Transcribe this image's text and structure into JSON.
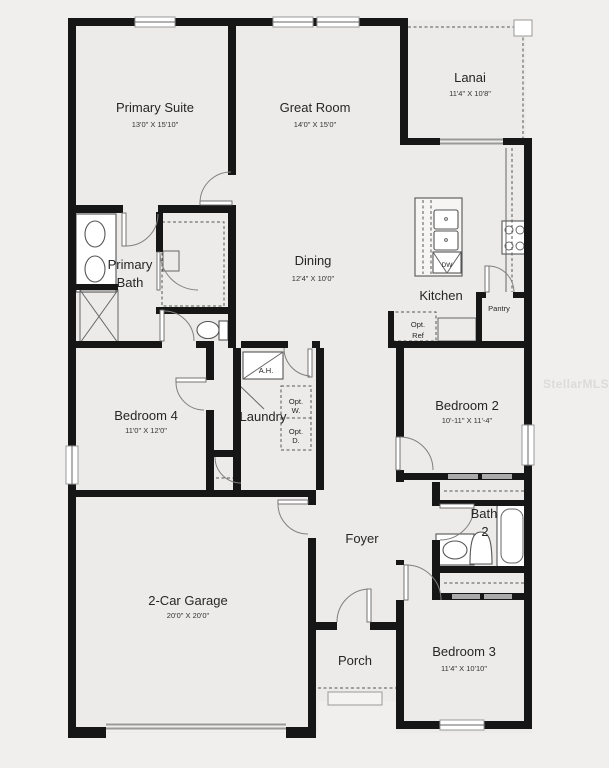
{
  "plan": {
    "watermark": "StellarMLS",
    "colors": {
      "wall": "#161616",
      "room_fill": "#ecebe9",
      "background": "#f0efee",
      "fixture_line": "#555555"
    },
    "rooms": {
      "primary_suite": {
        "name": "Primary Suite",
        "dims": "13'0\" X 15'10\""
      },
      "great_room": {
        "name": "Great Room",
        "dims": "14'0\" X 15'0\""
      },
      "lanai": {
        "name": "Lanai",
        "dims": "11'4\" X 10'8\""
      },
      "primary_bath": {
        "name_line1": "Primary",
        "name_line2": "Bath"
      },
      "dining": {
        "name": "Dining",
        "dims": "12'4\" X 10'0\""
      },
      "kitchen": {
        "name": "Kitchen"
      },
      "pantry": {
        "name": "Pantry"
      },
      "bedroom4": {
        "name": "Bedroom 4",
        "dims": "11'0\" X 12'0\""
      },
      "laundry": {
        "name": "Laundry"
      },
      "bedroom2": {
        "name": "Bedroom 2",
        "dims": "10'-11\" X 11'-4\""
      },
      "bath2": {
        "name_line1": "Bath",
        "name_line2": "2"
      },
      "foyer": {
        "name": "Foyer"
      },
      "garage": {
        "name": "2-Car Garage",
        "dims": "20'0\" X 20'0\""
      },
      "porch": {
        "name": "Porch"
      },
      "bedroom3": {
        "name": "Bedroom 3",
        "dims": "11'4\" X 10'10\""
      }
    },
    "fixtures": {
      "air_handler": "A.H.",
      "dishwasher": "DW",
      "opt_washer_line1": "Opt.",
      "opt_washer_line2": "W.",
      "opt_dryer_line1": "Opt.",
      "opt_dryer_line2": "D.",
      "opt_fridge_line1": "Opt.",
      "opt_fridge_line2": "Ref"
    }
  }
}
